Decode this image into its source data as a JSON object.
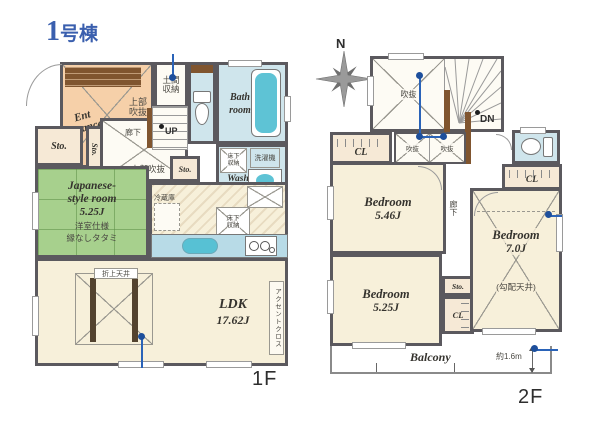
{
  "title": {
    "num": "1",
    "suffix": "号棟"
  },
  "f1": {
    "label": "1F",
    "entrance": "Ent\nrance",
    "upper_void": "上部\n吹抜",
    "doma": "土間\n収納",
    "bath": "Bath\nroom",
    "wash": "Wash\nroom",
    "washer": "洗濯機",
    "underfloor_small": "床下\n収納",
    "sto": "Sto.",
    "corridor": "廊下",
    "up": "UP",
    "upper_void2": "上部吹抜",
    "jp_name": "Japanese-\nstyle room",
    "jp_area": "5.25J",
    "jp_note1": "洋室仕様",
    "jp_note2": "縁なしタタミ",
    "fridge": "冷蔵庫",
    "kitchen_underfloor": "床下\n収納",
    "ldk_name": "LDK",
    "ldk_area": "17.62J",
    "coffered": "折上天井",
    "accent": "アクセントクロス"
  },
  "f2": {
    "label": "2F",
    "north": "N",
    "void": "吹抜",
    "void_small": "吹抜",
    "dn": "DN",
    "cl": "CL",
    "sto": "Sto.",
    "corridor": "廊下",
    "bed1_name": "Bedroom",
    "bed1_area": "5.46J",
    "bed2_name": "Bedroom",
    "bed2_area": "5.25J",
    "bed3_name": "Bedroom",
    "bed3_area": "7.0J",
    "bed3_note": "(勾配天井)",
    "balcony": "Balcony",
    "depth": "約1.6m"
  },
  "colors": {
    "wall": "#5b595e",
    "title_blue": "#3a5fae",
    "marker_blue": "#1d4f9c",
    "entrance_peach": "#f6d0a9",
    "tatami_green": "#a7d08d",
    "room_cream": "#f7f0da",
    "wet_blue": "#cfe5ec",
    "tub_cyan": "#5ec3d5",
    "wood_brown": "#80552f",
    "closet_tan": "#f6e9d6"
  }
}
